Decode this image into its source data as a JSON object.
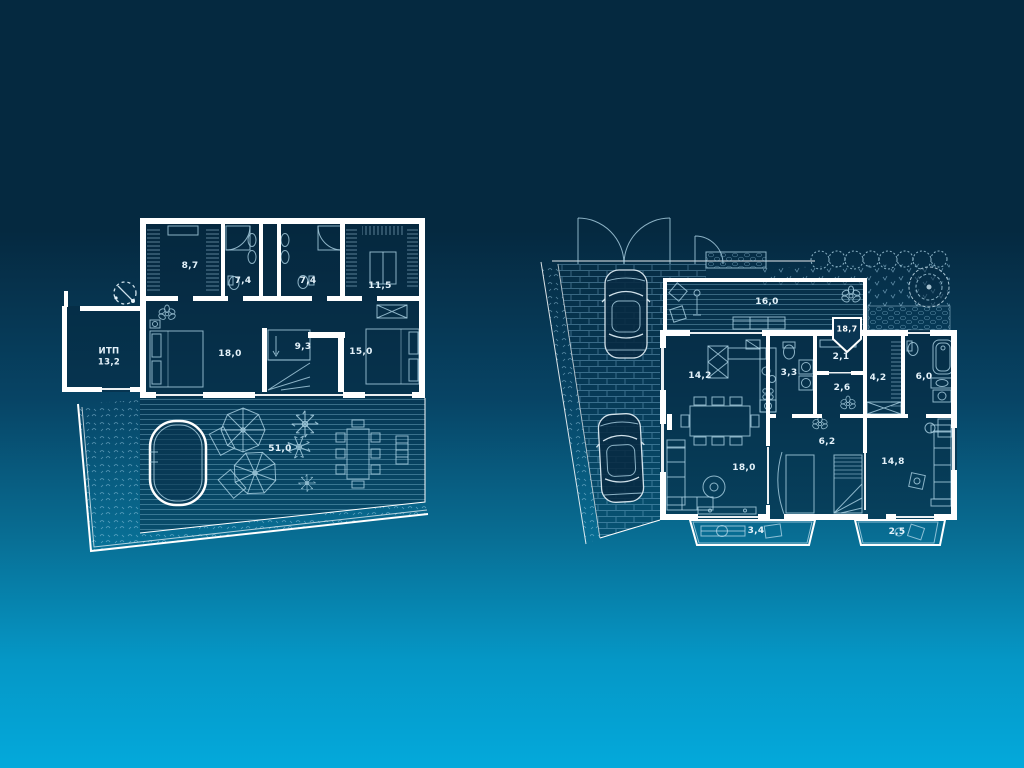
{
  "scene": "two-storey house blueprint floor plans",
  "palette": {
    "background_top": "#052940",
    "background_bottom": "#04a9db",
    "wall_color": "#ffffff",
    "furniture_line_color": "#aed4e6",
    "room_fill": "#06283f",
    "label_color": "#e4f2fa"
  },
  "left_plan": {
    "name": "upper-floor-plan",
    "compass_icon": "compass",
    "rooms": [
      {
        "key": "wardrobe-a",
        "area": "8,7"
      },
      {
        "key": "bathroom-a",
        "area": "7,4"
      },
      {
        "key": "bathroom-b",
        "area": "7,4"
      },
      {
        "key": "wardrobe-b",
        "area": "11,5"
      },
      {
        "key": "itp",
        "name": "ИТП",
        "area": "13,2"
      },
      {
        "key": "bedroom-a",
        "area": "18,0"
      },
      {
        "key": "stair-hall",
        "area": "9,3"
      },
      {
        "key": "bedroom-b",
        "area": "15,0"
      },
      {
        "key": "terrace-pool",
        "area": "51,0"
      }
    ]
  },
  "right_plan": {
    "name": "ground-floor-plan",
    "badge": {
      "area": "18,7"
    },
    "rooms": [
      {
        "key": "terrace",
        "area": "16,0"
      },
      {
        "key": "kitchen-dining",
        "area": "14,2"
      },
      {
        "key": "wc",
        "area": "3,3"
      },
      {
        "key": "storage",
        "area": "2,1"
      },
      {
        "key": "hall",
        "area": "2,6"
      },
      {
        "key": "wardrobe",
        "area": "4,2"
      },
      {
        "key": "bathroom",
        "area": "6,0"
      },
      {
        "key": "stair-hall",
        "area": "6,2"
      },
      {
        "key": "living-room",
        "area": "18,0"
      },
      {
        "key": "bedroom",
        "area": "14,8"
      },
      {
        "key": "porch-a",
        "area": "3,4"
      },
      {
        "key": "porch-b",
        "area": "2,5"
      }
    ]
  }
}
